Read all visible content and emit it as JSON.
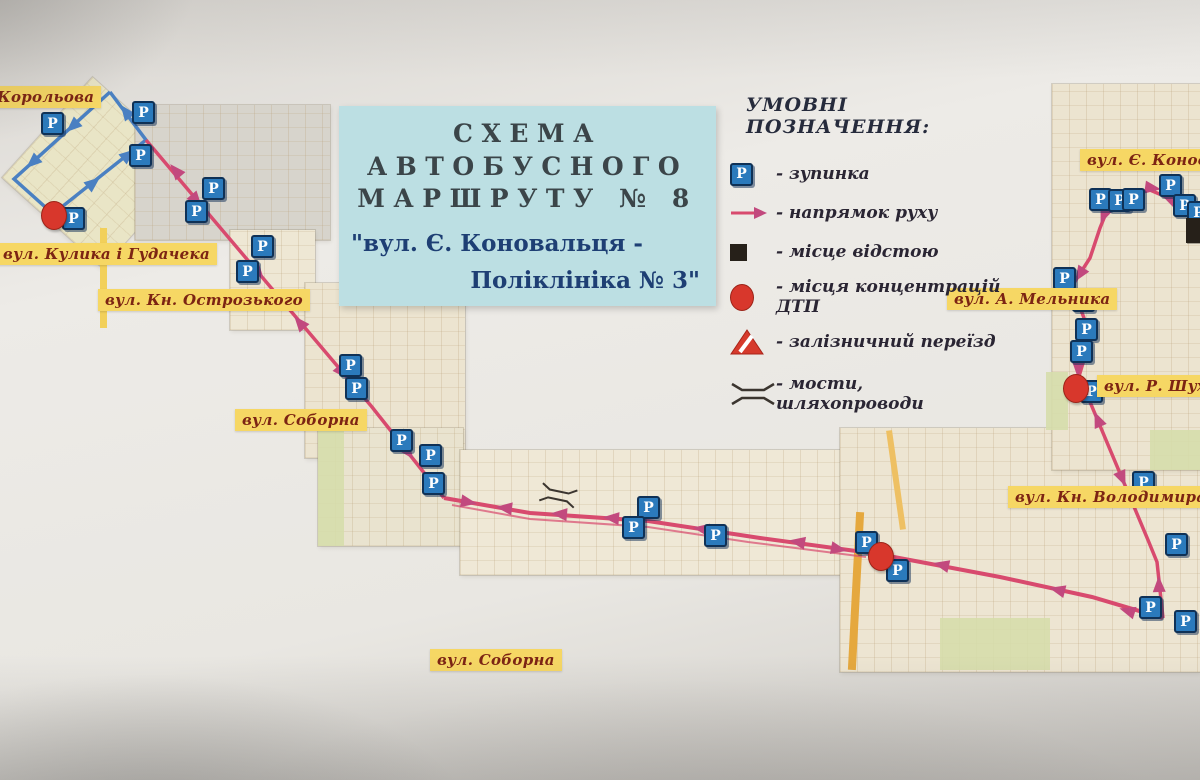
{
  "title_box": {
    "line1": "СХЕМА",
    "line2": "АВТОБУСНОГО",
    "line3": "МАРШРУТУ  № 8",
    "subtitle_line1": "\"вул. Є. Коновальця -",
    "subtitle_line2": "Поліклініка № 3\""
  },
  "legend": {
    "title": "УМОВНІ ПОЗНАЧЕННЯ:",
    "items": [
      {
        "icon": "bus-stop",
        "label": "- зупинка"
      },
      {
        "icon": "direction-arrow",
        "label": "- напрямок руху"
      },
      {
        "icon": "layover-square",
        "label": "- місце відстою"
      },
      {
        "icon": "accident-circle",
        "label": "- місця концентрацій ДТП"
      },
      {
        "icon": "railway-crossing",
        "label": "- залізничний переїзд"
      },
      {
        "icon": "bridge",
        "label": "- мости, шляхопроводи"
      }
    ]
  },
  "street_labels": [
    {
      "text": "Корольова",
      "x": -10,
      "y": 86
    },
    {
      "text": "вул. Кулика і Гудачека",
      "x": -4,
      "y": 243
    },
    {
      "text": "вул. Кн. Острозького",
      "x": 98,
      "y": 289
    },
    {
      "text": "вул. Соборна",
      "x": 235,
      "y": 409
    },
    {
      "text": "вул. Соборна",
      "x": 430,
      "y": 649
    },
    {
      "text": "вул. Є. Коновальця",
      "x": 1080,
      "y": 149
    },
    {
      "text": "вул. А. Мельника",
      "x": 947,
      "y": 288
    },
    {
      "text": "вул. Р. Шухевича",
      "x": 1097,
      "y": 375
    },
    {
      "text": "вул. Кн. Володимира",
      "x": 1008,
      "y": 486
    }
  ],
  "colors": {
    "route_pink": "#d84a6e",
    "arrow_pink": "#c2497e",
    "loop_blue": "#4a80c2",
    "stop_blue": "#2b7abc",
    "stop_border": "#0f3156",
    "accident_red": "#d8372c",
    "layover_black": "#262019",
    "label_bg": "#f6d764",
    "label_text": "#7c2413",
    "title_bg": "#bcdfe3",
    "bridge_stroke": "#3b352f"
  },
  "map": {
    "stop_letter": "P",
    "stops": [
      [
        52,
        124
      ],
      [
        143,
        113
      ],
      [
        140,
        156
      ],
      [
        73,
        219
      ],
      [
        213,
        189
      ],
      [
        196,
        212
      ],
      [
        262,
        247
      ],
      [
        247,
        272
      ],
      [
        350,
        366
      ],
      [
        356,
        389
      ],
      [
        401,
        441
      ],
      [
        430,
        456
      ],
      [
        433,
        484
      ],
      [
        648,
        508
      ],
      [
        633,
        528
      ],
      [
        715,
        536
      ],
      [
        866,
        543
      ],
      [
        897,
        571
      ],
      [
        1100,
        200
      ],
      [
        1119,
        201
      ],
      [
        1133,
        200
      ],
      [
        1170,
        186
      ],
      [
        1184,
        206
      ],
      [
        1198,
        213
      ],
      [
        1064,
        279
      ],
      [
        1083,
        301
      ],
      [
        1086,
        330
      ],
      [
        1081,
        352
      ],
      [
        1091,
        392
      ],
      [
        1143,
        483
      ],
      [
        1176,
        545
      ],
      [
        1150,
        608
      ],
      [
        1185,
        622
      ]
    ],
    "accidents": [
      [
        53,
        214
      ],
      [
        880,
        555
      ],
      [
        1075,
        387
      ]
    ],
    "layover": {
      "x": 1186,
      "y": 218,
      "w": 16,
      "h": 25
    },
    "routes": [
      {
        "name": "turnaround-loop",
        "color": "#4a80c2",
        "width": 3.5,
        "opacity": 1,
        "points": [
          [
            110,
            92
          ],
          [
            14,
            179
          ],
          [
            53,
            214
          ],
          [
            146,
            140
          ],
          [
            110,
            92
          ]
        ]
      },
      {
        "name": "route-northwest-diagonal",
        "color": "#d84a6e",
        "width": 3.5,
        "opacity": 1,
        "points": [
          [
            146,
            140
          ],
          [
            372,
            407
          ],
          [
            444,
            498
          ]
        ]
      },
      {
        "name": "route-central-corridor",
        "color": "#d84a6e",
        "width": 4,
        "opacity": 1,
        "points": [
          [
            444,
            498
          ],
          [
            530,
            513
          ],
          [
            648,
            521
          ],
          [
            760,
            538
          ],
          [
            878,
            554
          ],
          [
            1000,
            577
          ],
          [
            1092,
            597
          ],
          [
            1163,
            618
          ]
        ]
      },
      {
        "name": "route-corridor-return",
        "color": "#d84a6e",
        "width": 2,
        "opacity": 0.7,
        "points": [
          [
            452,
            505
          ],
          [
            530,
            519
          ],
          [
            648,
            527
          ],
          [
            748,
            542
          ],
          [
            866,
            557
          ]
        ]
      },
      {
        "name": "route-southeast-branch",
        "color": "#d84a6e",
        "width": 3.5,
        "opacity": 1,
        "points": [
          [
            1163,
            618
          ],
          [
            1157,
            562
          ],
          [
            1148,
            540
          ],
          [
            1085,
            390
          ]
        ]
      },
      {
        "name": "route-konovaltsia-segment",
        "color": "#d84a6e",
        "width": 3.5,
        "opacity": 1,
        "points": [
          [
            1199,
            211
          ],
          [
            1150,
            190
          ],
          [
            1113,
            196
          ],
          [
            1100,
            228
          ],
          [
            1090,
            258
          ],
          [
            1072,
            286
          ],
          [
            1084,
            318
          ],
          [
            1087,
            350
          ],
          [
            1076,
            386
          ]
        ]
      }
    ],
    "arrows": [
      {
        "x": 73,
        "y": 126,
        "a": 138,
        "c": "#4a80c2"
      },
      {
        "x": 33,
        "y": 162,
        "a": 138,
        "c": "#4a80c2"
      },
      {
        "x": 93,
        "y": 183,
        "a": -39,
        "c": "#4a80c2"
      },
      {
        "x": 128,
        "y": 155,
        "a": -39,
        "c": "#4a80c2"
      },
      {
        "x": 126,
        "y": 112,
        "a": 233,
        "c": "#4a80c2"
      },
      {
        "x": 176,
        "y": 171,
        "a": 230,
        "c": "#c2497e"
      },
      {
        "x": 196,
        "y": 200,
        "a": 50,
        "c": "#c2497e"
      },
      {
        "x": 258,
        "y": 272,
        "a": 50,
        "c": "#c2497e"
      },
      {
        "x": 300,
        "y": 323,
        "a": 230,
        "c": "#c2497e"
      },
      {
        "x": 342,
        "y": 372,
        "a": 50,
        "c": "#c2497e"
      },
      {
        "x": 408,
        "y": 452,
        "a": 52,
        "c": "#c2497e"
      },
      {
        "x": 468,
        "y": 502,
        "a": 10,
        "c": "#c2497e"
      },
      {
        "x": 505,
        "y": 508,
        "a": 187,
        "c": "#c2497e"
      },
      {
        "x": 560,
        "y": 514,
        "a": 185,
        "c": "#c2497e"
      },
      {
        "x": 612,
        "y": 518,
        "a": 185,
        "c": "#c2497e"
      },
      {
        "x": 702,
        "y": 529,
        "a": 189,
        "c": "#c2497e"
      },
      {
        "x": 798,
        "y": 542,
        "a": 190,
        "c": "#c2497e"
      },
      {
        "x": 838,
        "y": 549,
        "a": 11,
        "c": "#c2497e"
      },
      {
        "x": 942,
        "y": 565,
        "a": 193,
        "c": "#c2497e"
      },
      {
        "x": 1058,
        "y": 590,
        "a": 194,
        "c": "#c2497e"
      },
      {
        "x": 1128,
        "y": 611,
        "a": 197,
        "c": "#c2497e"
      },
      {
        "x": 1159,
        "y": 585,
        "a": 268,
        "c": "#c2497e"
      },
      {
        "x": 1130,
        "y": 497,
        "a": 247,
        "c": "#c2497e"
      },
      {
        "x": 1098,
        "y": 420,
        "a": 247,
        "c": "#c2497e"
      },
      {
        "x": 1122,
        "y": 478,
        "a": 67,
        "c": "#c2497e"
      },
      {
        "x": 1170,
        "y": 199,
        "a": 204,
        "c": "#c2497e"
      },
      {
        "x": 1152,
        "y": 188,
        "a": 8,
        "c": "#c2497e"
      },
      {
        "x": 1104,
        "y": 215,
        "a": 112,
        "c": "#c2497e"
      },
      {
        "x": 1080,
        "y": 274,
        "a": 123,
        "c": "#c2497e"
      },
      {
        "x": 1086,
        "y": 336,
        "a": 85,
        "c": "#c2497e"
      },
      {
        "x": 1078,
        "y": 368,
        "a": 93,
        "c": "#c2497e"
      }
    ],
    "bridges": [
      {
        "x": 558,
        "y": 497,
        "rot": 12
      }
    ]
  }
}
